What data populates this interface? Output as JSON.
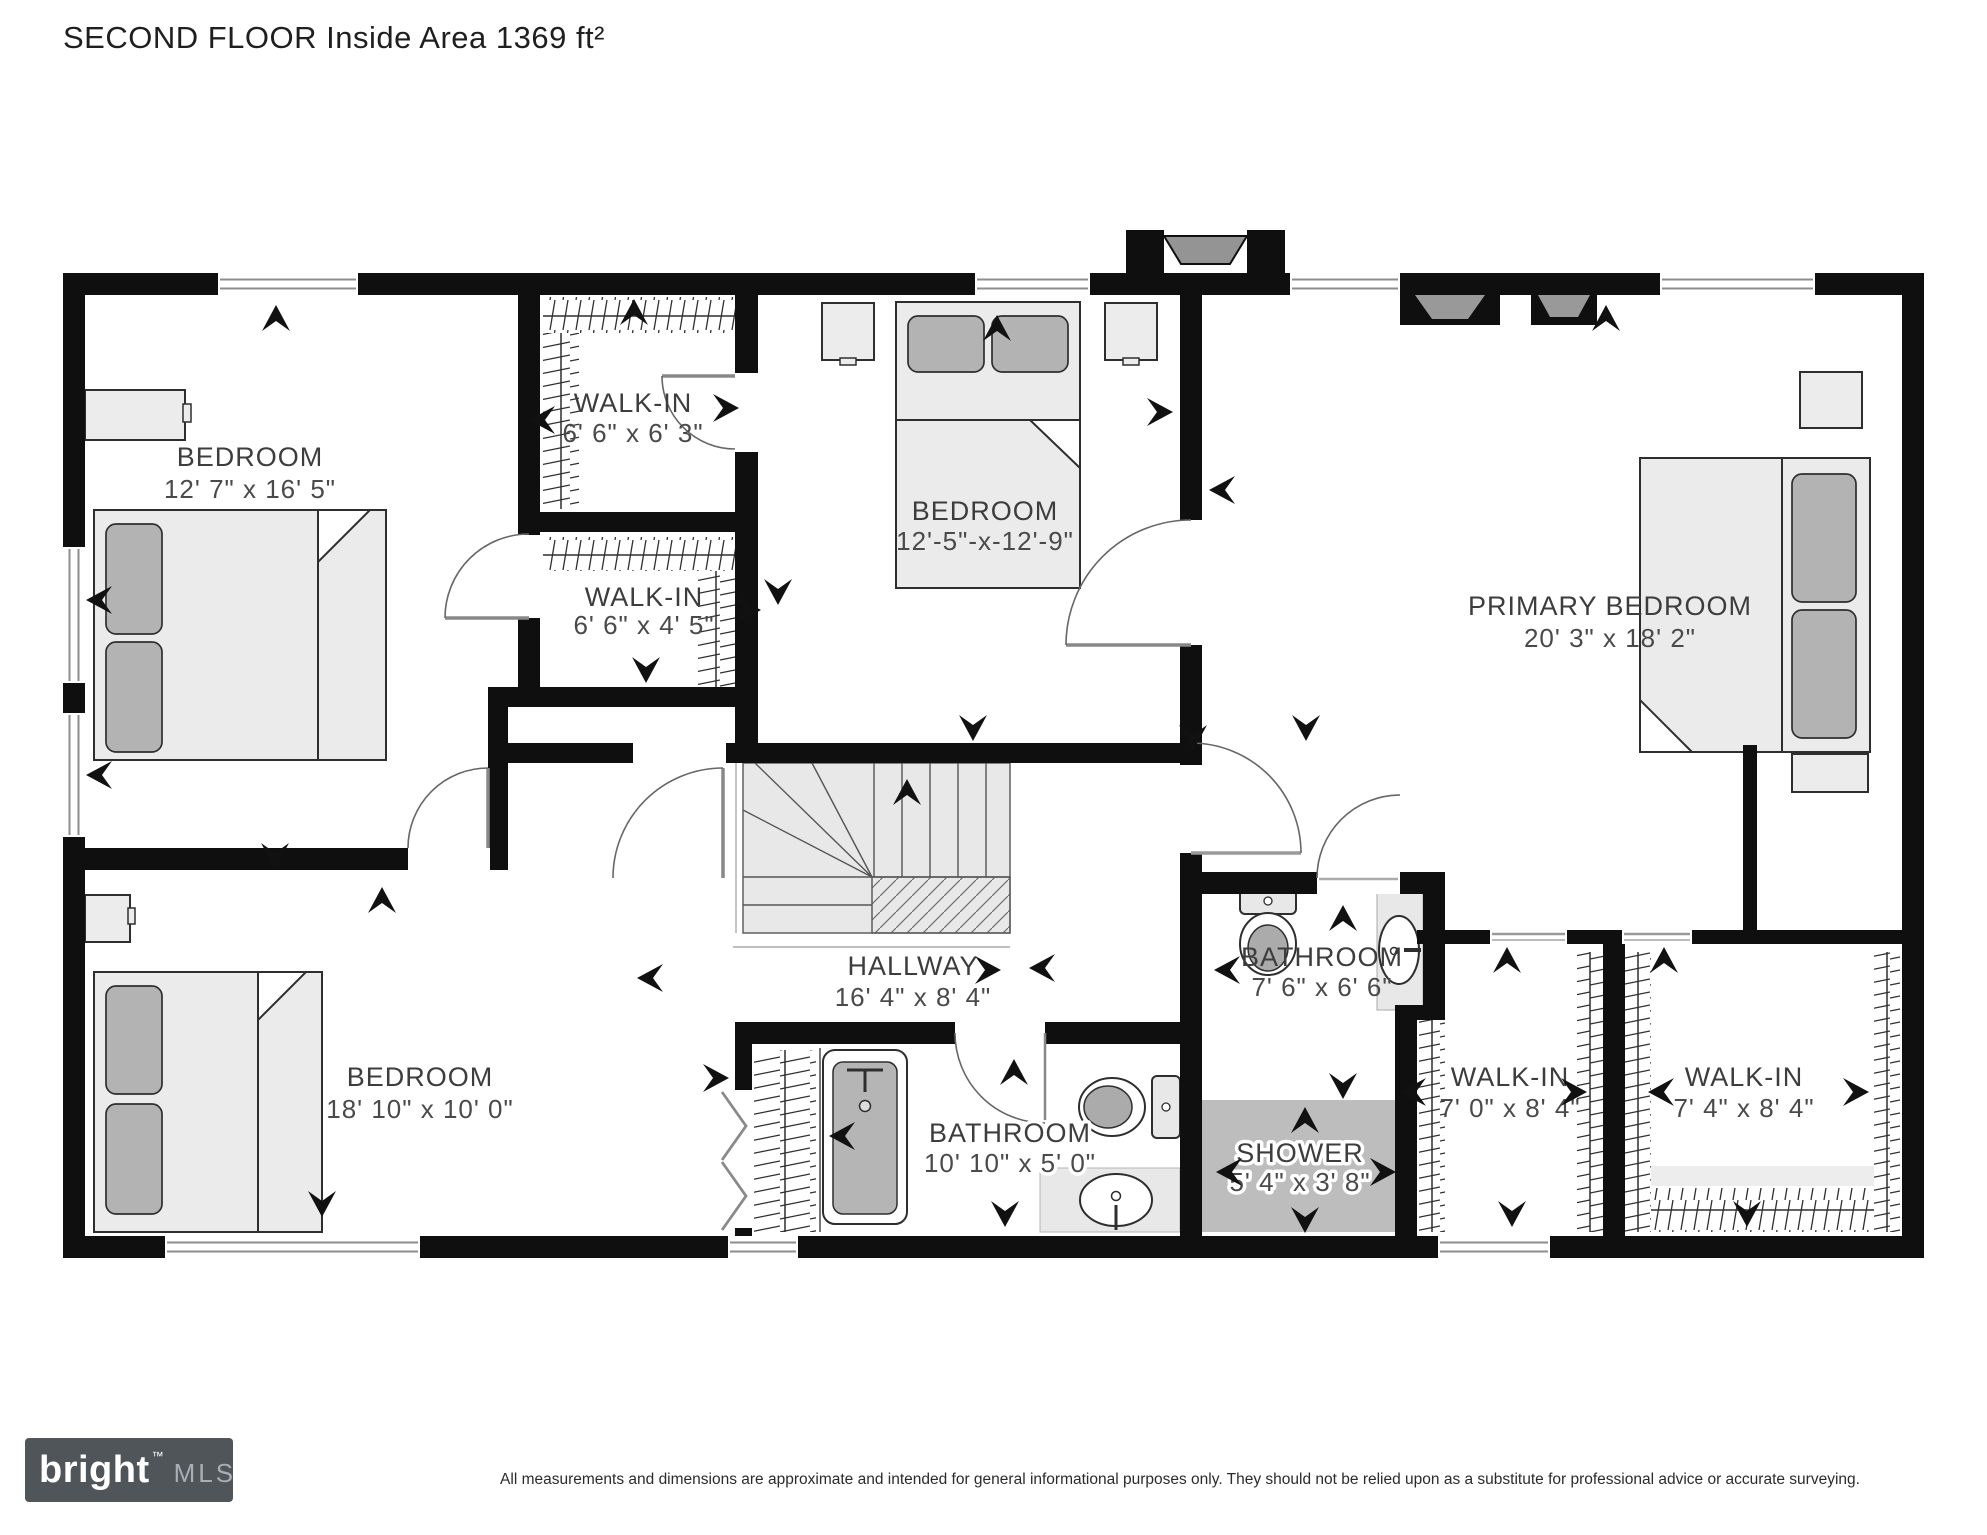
{
  "title": "SECOND FLOOR Inside Area 1369 ft²",
  "rooms": {
    "bedroom_top_left": {
      "name": "BEDROOM",
      "dims": "12' 7\" x 16' 5\""
    },
    "walk_in_top": {
      "name": "WALK-IN",
      "dims": "6' 6\" x 6' 3\""
    },
    "walk_in_mid": {
      "name": "WALK-IN",
      "dims": "6' 6\" x 4' 5\""
    },
    "bedroom_middle": {
      "name": "BEDROOM",
      "dims": "12'-5\"-x-12'-9\""
    },
    "primary_bedroom": {
      "name": "PRIMARY BEDROOM",
      "dims": "20' 3\" x 18' 2\""
    },
    "bedroom_bottom_left": {
      "name": "BEDROOM",
      "dims": "18' 10\" x 10' 0\""
    },
    "hallway": {
      "name": "HALLWAY",
      "dims": "16' 4\" x 8' 4\""
    },
    "bathroom_main": {
      "name": "BATHROOM",
      "dims": "10' 10\" x 5' 0\""
    },
    "bathroom_ensuite": {
      "name": "BATHROOM",
      "dims": "7' 6\" x 6' 6\""
    },
    "shower": {
      "name": "SHOWER",
      "dims": "5' 4\" x 3' 8\""
    },
    "walk_in_right_1": {
      "name": "WALK-IN",
      "dims": "7' 0\" x 8' 4\""
    },
    "walk_in_right_2": {
      "name": "WALK-IN",
      "dims": "7' 4\" x 8' 4\""
    }
  },
  "footer": {
    "brand": "bright",
    "brand_tm": "™",
    "brand_mls": "MLS",
    "disclaimer": "All measurements and dimensions are approximate and intended for general informational purposes only. They should not be relied upon as a substitute for professional advice or accurate surveying."
  },
  "colors": {
    "wall": "#0f0f0f",
    "furniture_fill": "#ececec",
    "pillow_fill": "#b3b3b3",
    "stairs_fill": "#e8e8e8",
    "shower_fill": "#bdbdbd",
    "label_text": "#3d3d3d",
    "logo_bg": "#50555a"
  }
}
